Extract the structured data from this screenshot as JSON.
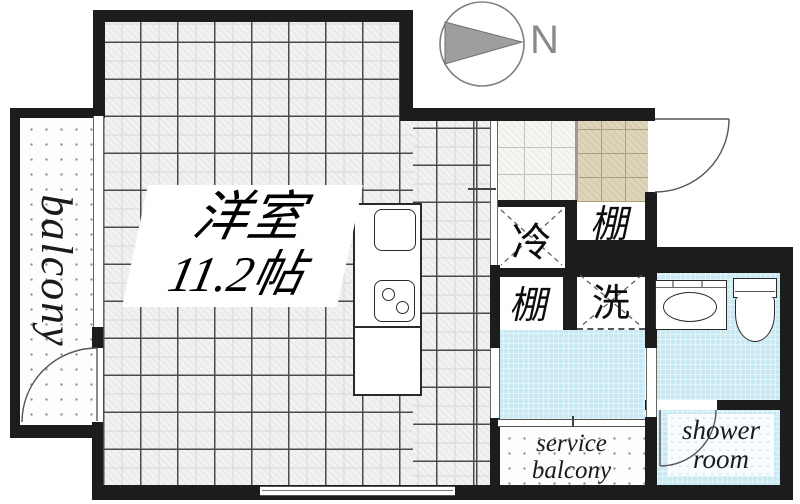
{
  "floorplan": {
    "compass_label": "N",
    "main_room": {
      "name": "洋室",
      "size": "11.2帖"
    },
    "balcony": {
      "label": "balcony"
    },
    "service_balcony": {
      "line1": "service",
      "line2": "balcony"
    },
    "shower_room": {
      "line1": "shower",
      "line2": "room"
    },
    "refrigerator_label": "冷",
    "shelf_upper_label": "棚",
    "shelf_lower_label": "棚",
    "washer_label": "洗"
  },
  "colors": {
    "wall": "#1c1c1c",
    "water_blue": "#c9e9f2",
    "genkan_beige": "#ded5bb",
    "compass_gray": "#9e9e9e"
  }
}
